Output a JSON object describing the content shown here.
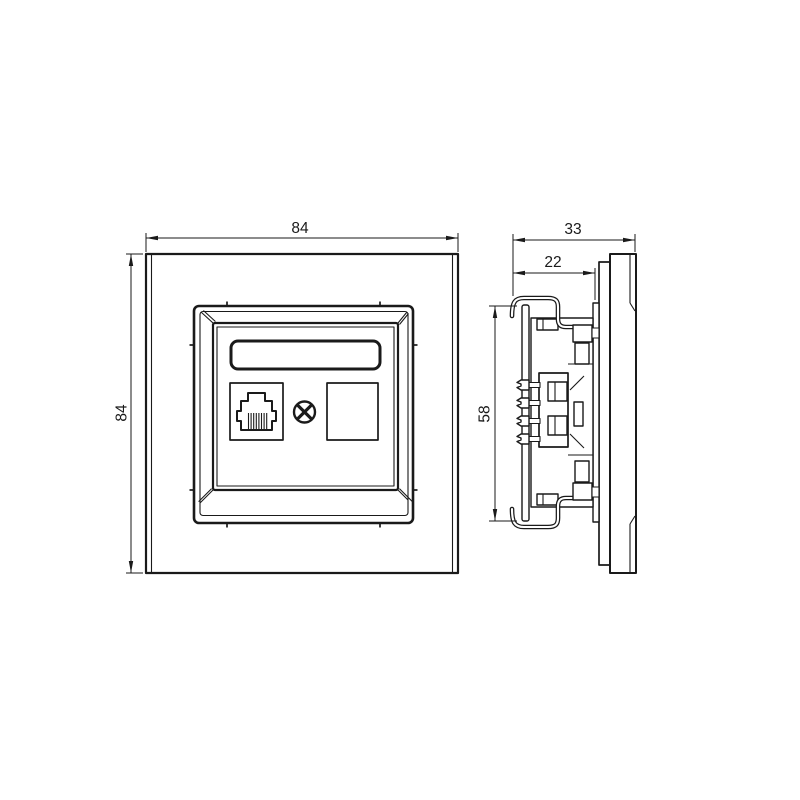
{
  "dimensions": {
    "front_width": "84",
    "front_height": "84",
    "insert_height": "58",
    "depth_total": "33",
    "insert_depth": "22"
  },
  "colors": {
    "line": "#1a1a1a",
    "background": "#ffffff"
  },
  "views": {
    "front": "front-view-of-faceplate-with-rj45-port-screw-and-blank-port",
    "side": "side-view-of-flush-mount-insert-with-mounting-claws"
  }
}
